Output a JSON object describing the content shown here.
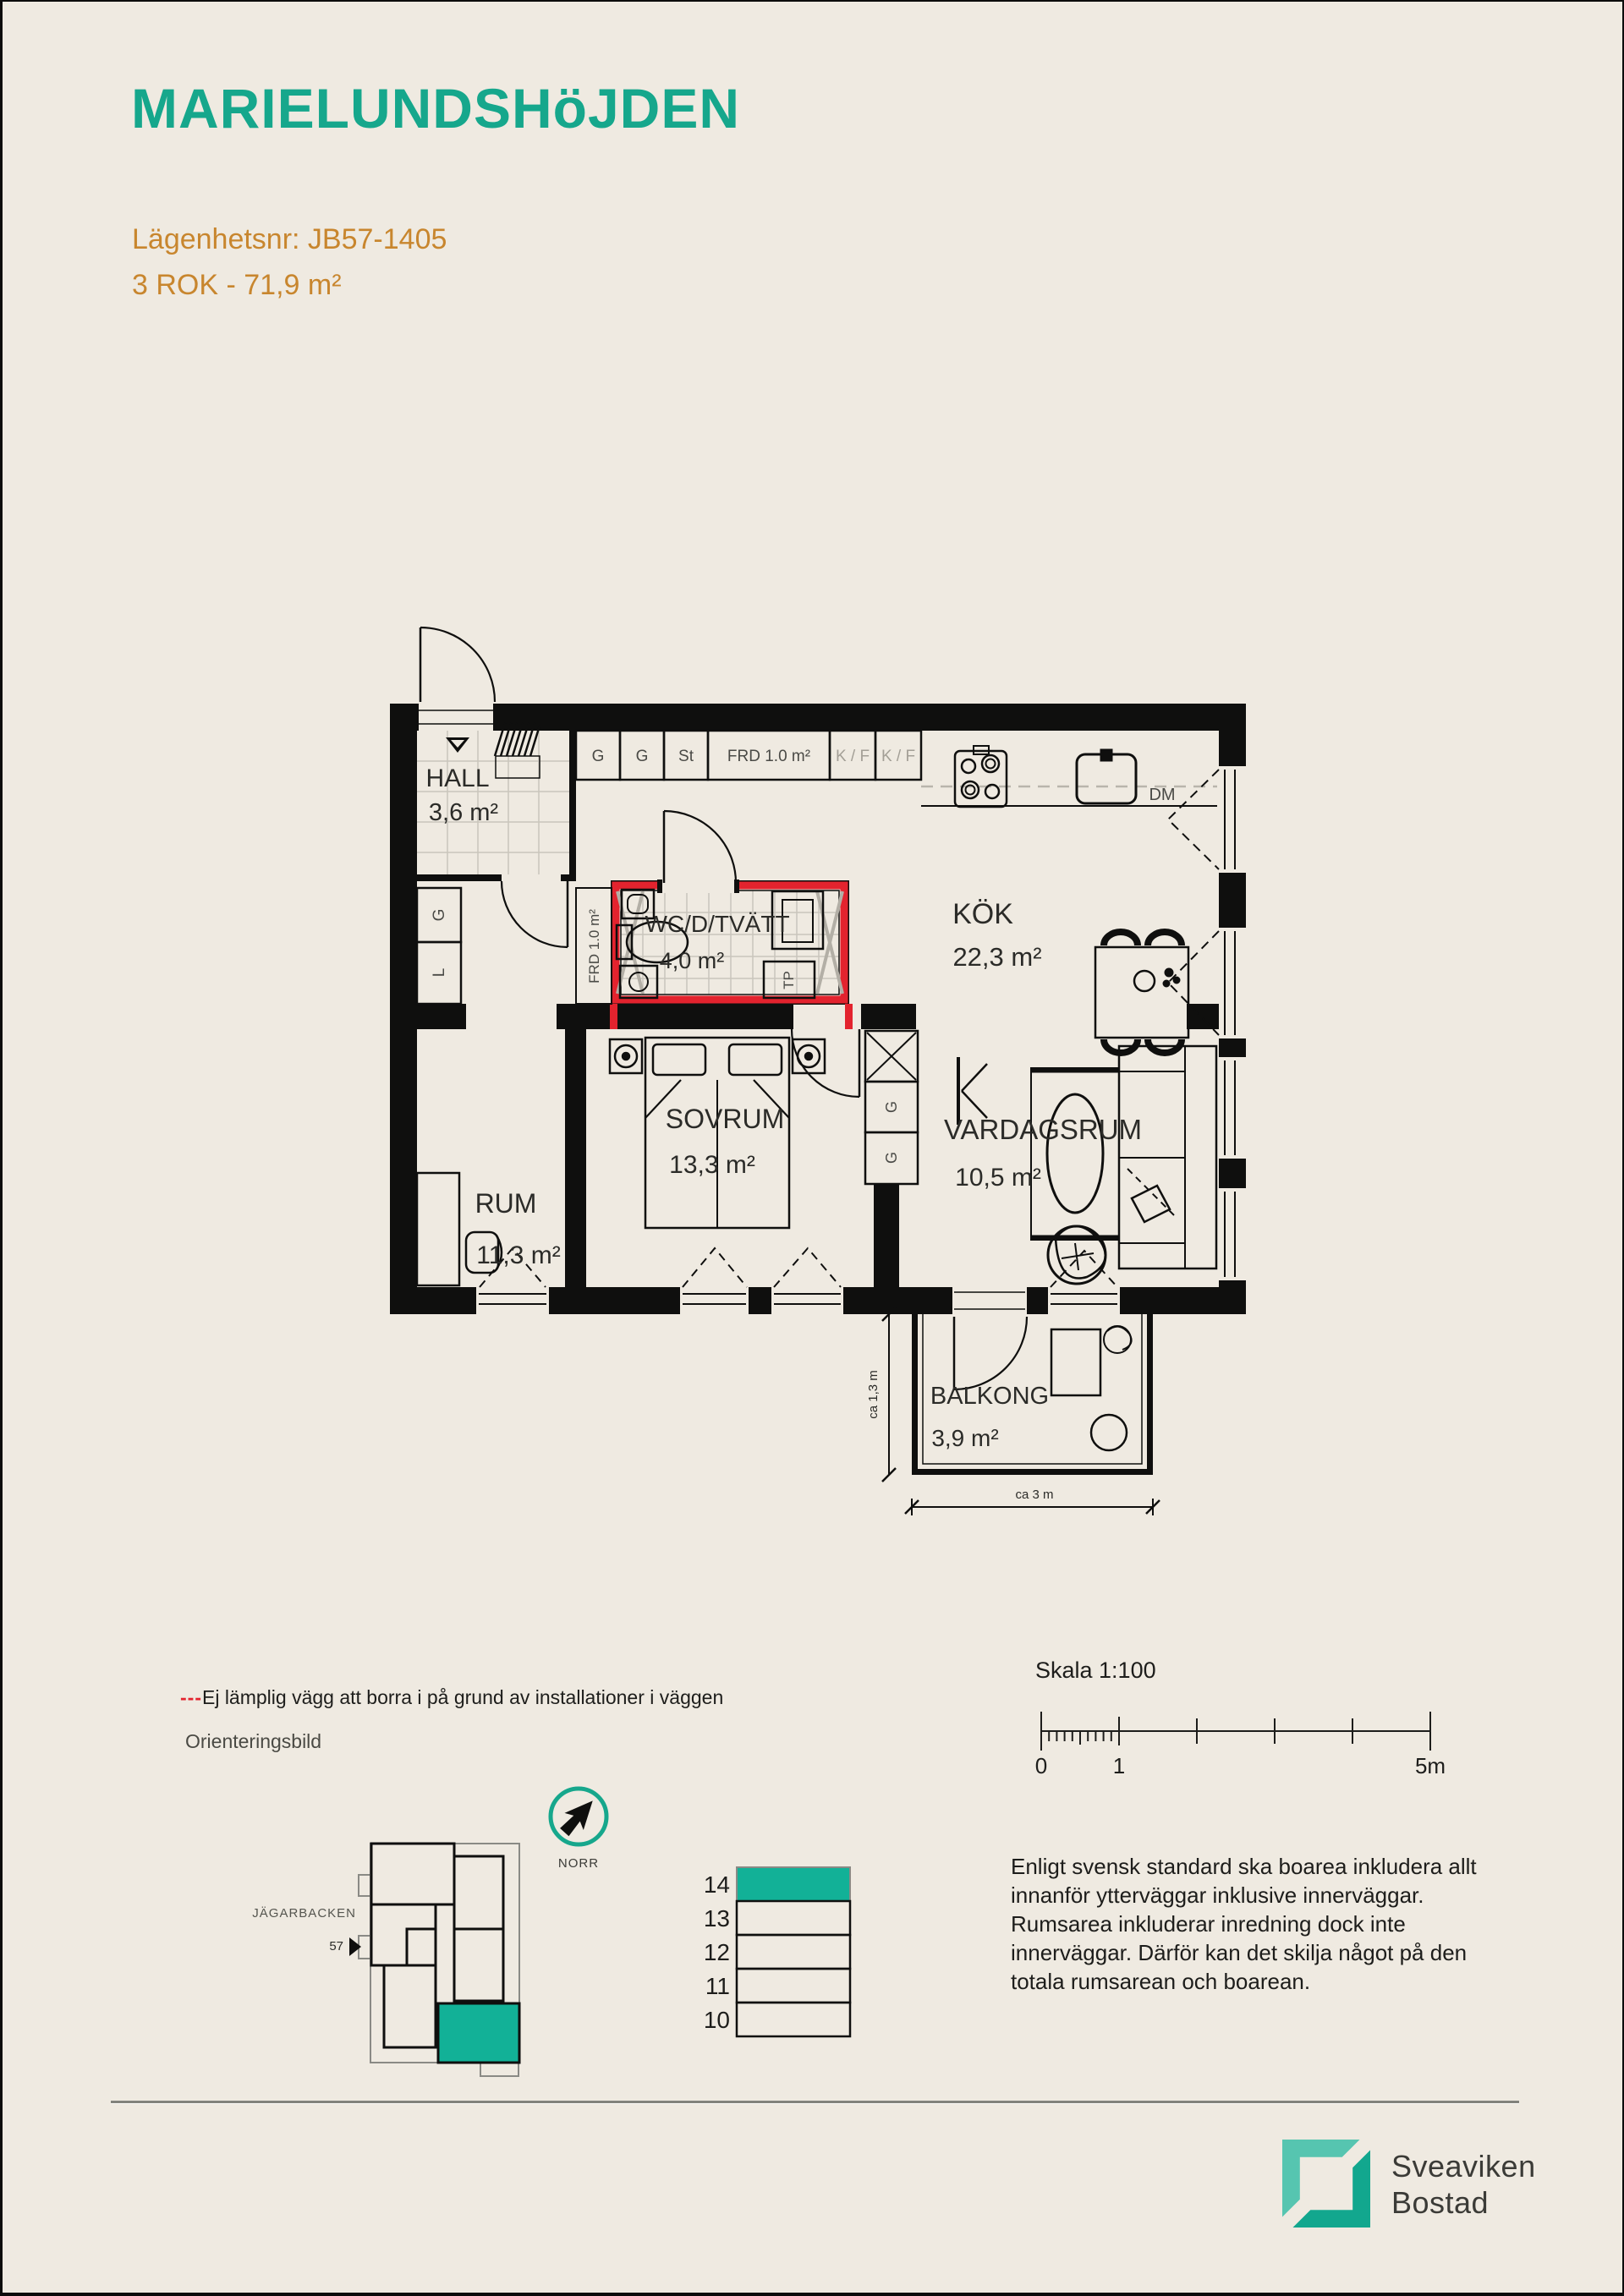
{
  "document": {
    "project_title": "MARIELUNDSHöJDEN",
    "apartment_line": "Lägenhetsnr: JB57-1405",
    "rok_line": "3 ROK  -  71,9 m²"
  },
  "floorplan": {
    "rooms": {
      "hall": {
        "name": "HALL",
        "area": "3,6 m²"
      },
      "kok": {
        "name": "KÖK",
        "area": "22,3 m²"
      },
      "wc": {
        "name": "WC/D/TVÄTT",
        "area": "4,0 m²"
      },
      "rum": {
        "name": "RUM",
        "area": "11,3 m²"
      },
      "sovrum": {
        "name": "SOVRUM",
        "area": "13,3 m²"
      },
      "vardagsrum": {
        "name": "VARDAGSRUM",
        "area": "10,5 m²"
      },
      "balkong": {
        "name": "BALKONG",
        "area": "3,9 m²"
      }
    },
    "labels": {
      "g": "G",
      "l": "L",
      "st": "St",
      "frd": "FRD 1.0 m²",
      "kf": "K / F",
      "dm": "DM",
      "tp": "TP"
    },
    "dimensions": {
      "depth": "ca 1,3 m",
      "width": "ca 3 m"
    }
  },
  "annotations": {
    "drill_dashes": "---",
    "drill_note": "Ej lämplig vägg att borra i på grund av installationer i väggen",
    "orientation_title": "Orienteringsbild",
    "north_label": "NORR",
    "site_street": "JÄGARBACKEN",
    "site_number": "57"
  },
  "floor_selector": {
    "floors": [
      "14",
      "13",
      "12",
      "11",
      "10"
    ],
    "current": "14"
  },
  "scalebar": {
    "label": "Skala 1:100",
    "tick0": "0",
    "tick1": "1",
    "tick5": "5m"
  },
  "legal_text": "Enligt svensk standard ska boarea inkludera allt innanför ytterväggar inklusive innerväggar. Rumsarea inkluderar inredning dock inte innerväggar. Därför kan det skilja något på den totala rumsarean och boarean.",
  "logo": {
    "line1": "Sveaviken",
    "line2": "Bostad"
  },
  "colors": {
    "teal": "#16a78c",
    "teal_fill": "#12b197",
    "orange": "#c8862e",
    "red": "#e3232e",
    "background": "#efeae1",
    "wall": "#0f0f0e"
  }
}
